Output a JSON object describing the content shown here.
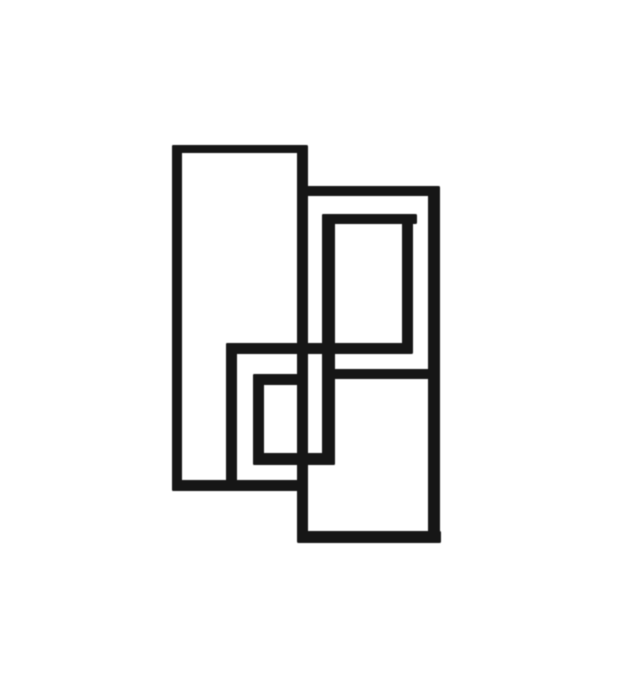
{
  "page": {
    "background_color": "#ffffff"
  },
  "artwork": {
    "stroke_color": "#191919",
    "canvas": {
      "width": 625,
      "height": 688
    },
    "segments": [
      {
        "name": "left-rect-top-edge",
        "x": 172,
        "y": 145,
        "w": 134,
        "h": 8
      },
      {
        "name": "upper-right-rect-top-edge",
        "x": 300,
        "y": 186,
        "w": 138,
        "h": 10
      },
      {
        "name": "inner-upper-rect-top-edge",
        "x": 322,
        "y": 214,
        "w": 95,
        "h": 10
      },
      {
        "name": "middle-horizontal-bar",
        "x": 226,
        "y": 343,
        "w": 185,
        "h": 11
      },
      {
        "name": "lower-right-rect-top-edge",
        "x": 329,
        "y": 369,
        "w": 111,
        "h": 10
      },
      {
        "name": "small-center-rect-top-edge",
        "x": 253,
        "y": 374,
        "w": 55,
        "h": 11
      },
      {
        "name": "small-center-rect-bottom-edge",
        "x": 253,
        "y": 453,
        "w": 82,
        "h": 12
      },
      {
        "name": "left-rect-bottom-edge",
        "x": 172,
        "y": 480,
        "w": 133,
        "h": 11
      },
      {
        "name": "lower-right-rect-bottom-edge",
        "x": 298,
        "y": 531,
        "w": 143,
        "h": 12
      },
      {
        "name": "left-rect-left-edge",
        "x": 172,
        "y": 145,
        "w": 10,
        "h": 346
      },
      {
        "name": "central-vertical-line",
        "x": 297,
        "y": 145,
        "w": 11,
        "h": 398
      },
      {
        "name": "center-rect-left-edge",
        "x": 226,
        "y": 343,
        "w": 11,
        "h": 148
      },
      {
        "name": "small-center-rect-left-edge",
        "x": 253,
        "y": 374,
        "w": 11,
        "h": 91
      },
      {
        "name": "inner-left-vertical-line",
        "x": 322,
        "y": 214,
        "w": 13,
        "h": 251
      },
      {
        "name": "inner-upper-rect-right-edge",
        "x": 402,
        "y": 214,
        "w": 11,
        "h": 140
      },
      {
        "name": "right-vertical-line",
        "x": 428,
        "y": 186,
        "w": 12,
        "h": 357
      }
    ]
  }
}
